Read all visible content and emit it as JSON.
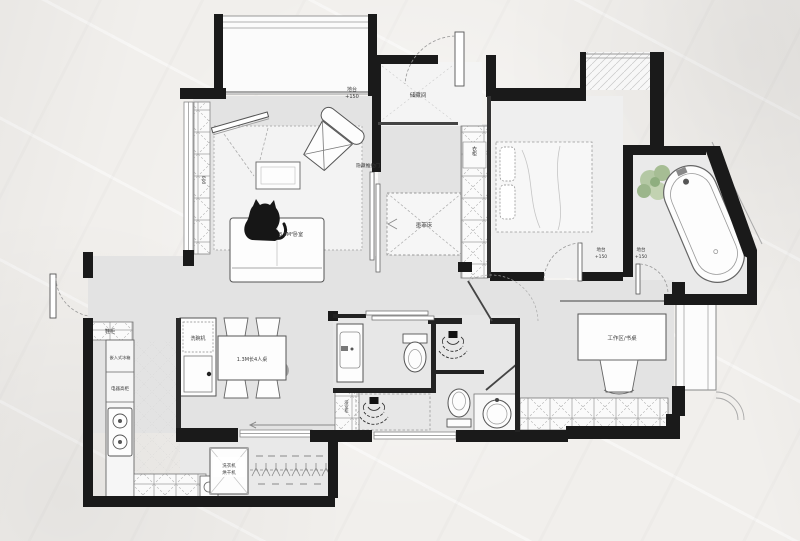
{
  "floorplan": {
    "labels": {
      "platform_line1": "地台",
      "platform_line2": "+150",
      "storage_room": "储藏间",
      "hidden_sliding_door": "隐藏推拉门",
      "murphy_bed": "墨菲床",
      "wardrobe": "衣柜",
      "left_cabinet_dim": "600",
      "living_area": "8.9M²卧室",
      "desk_area": "工作区/书桌",
      "shoe_cabinet": "鞋柜",
      "built_in_fridge": "嵌入式冰箱",
      "appliance_cabinet": "电器高柜",
      "dishwasher": "洗碗机",
      "dining_table": "1.3M长4人桌",
      "washer_line1": "洗衣机",
      "washer_line2": "烘干机",
      "bath_cabinet": "浴室柜"
    },
    "colors": {
      "wall": "#1a1a1a",
      "floor": "#e3e3e3",
      "paper": "#f1efec",
      "plant": "#b4c8a4"
    }
  }
}
